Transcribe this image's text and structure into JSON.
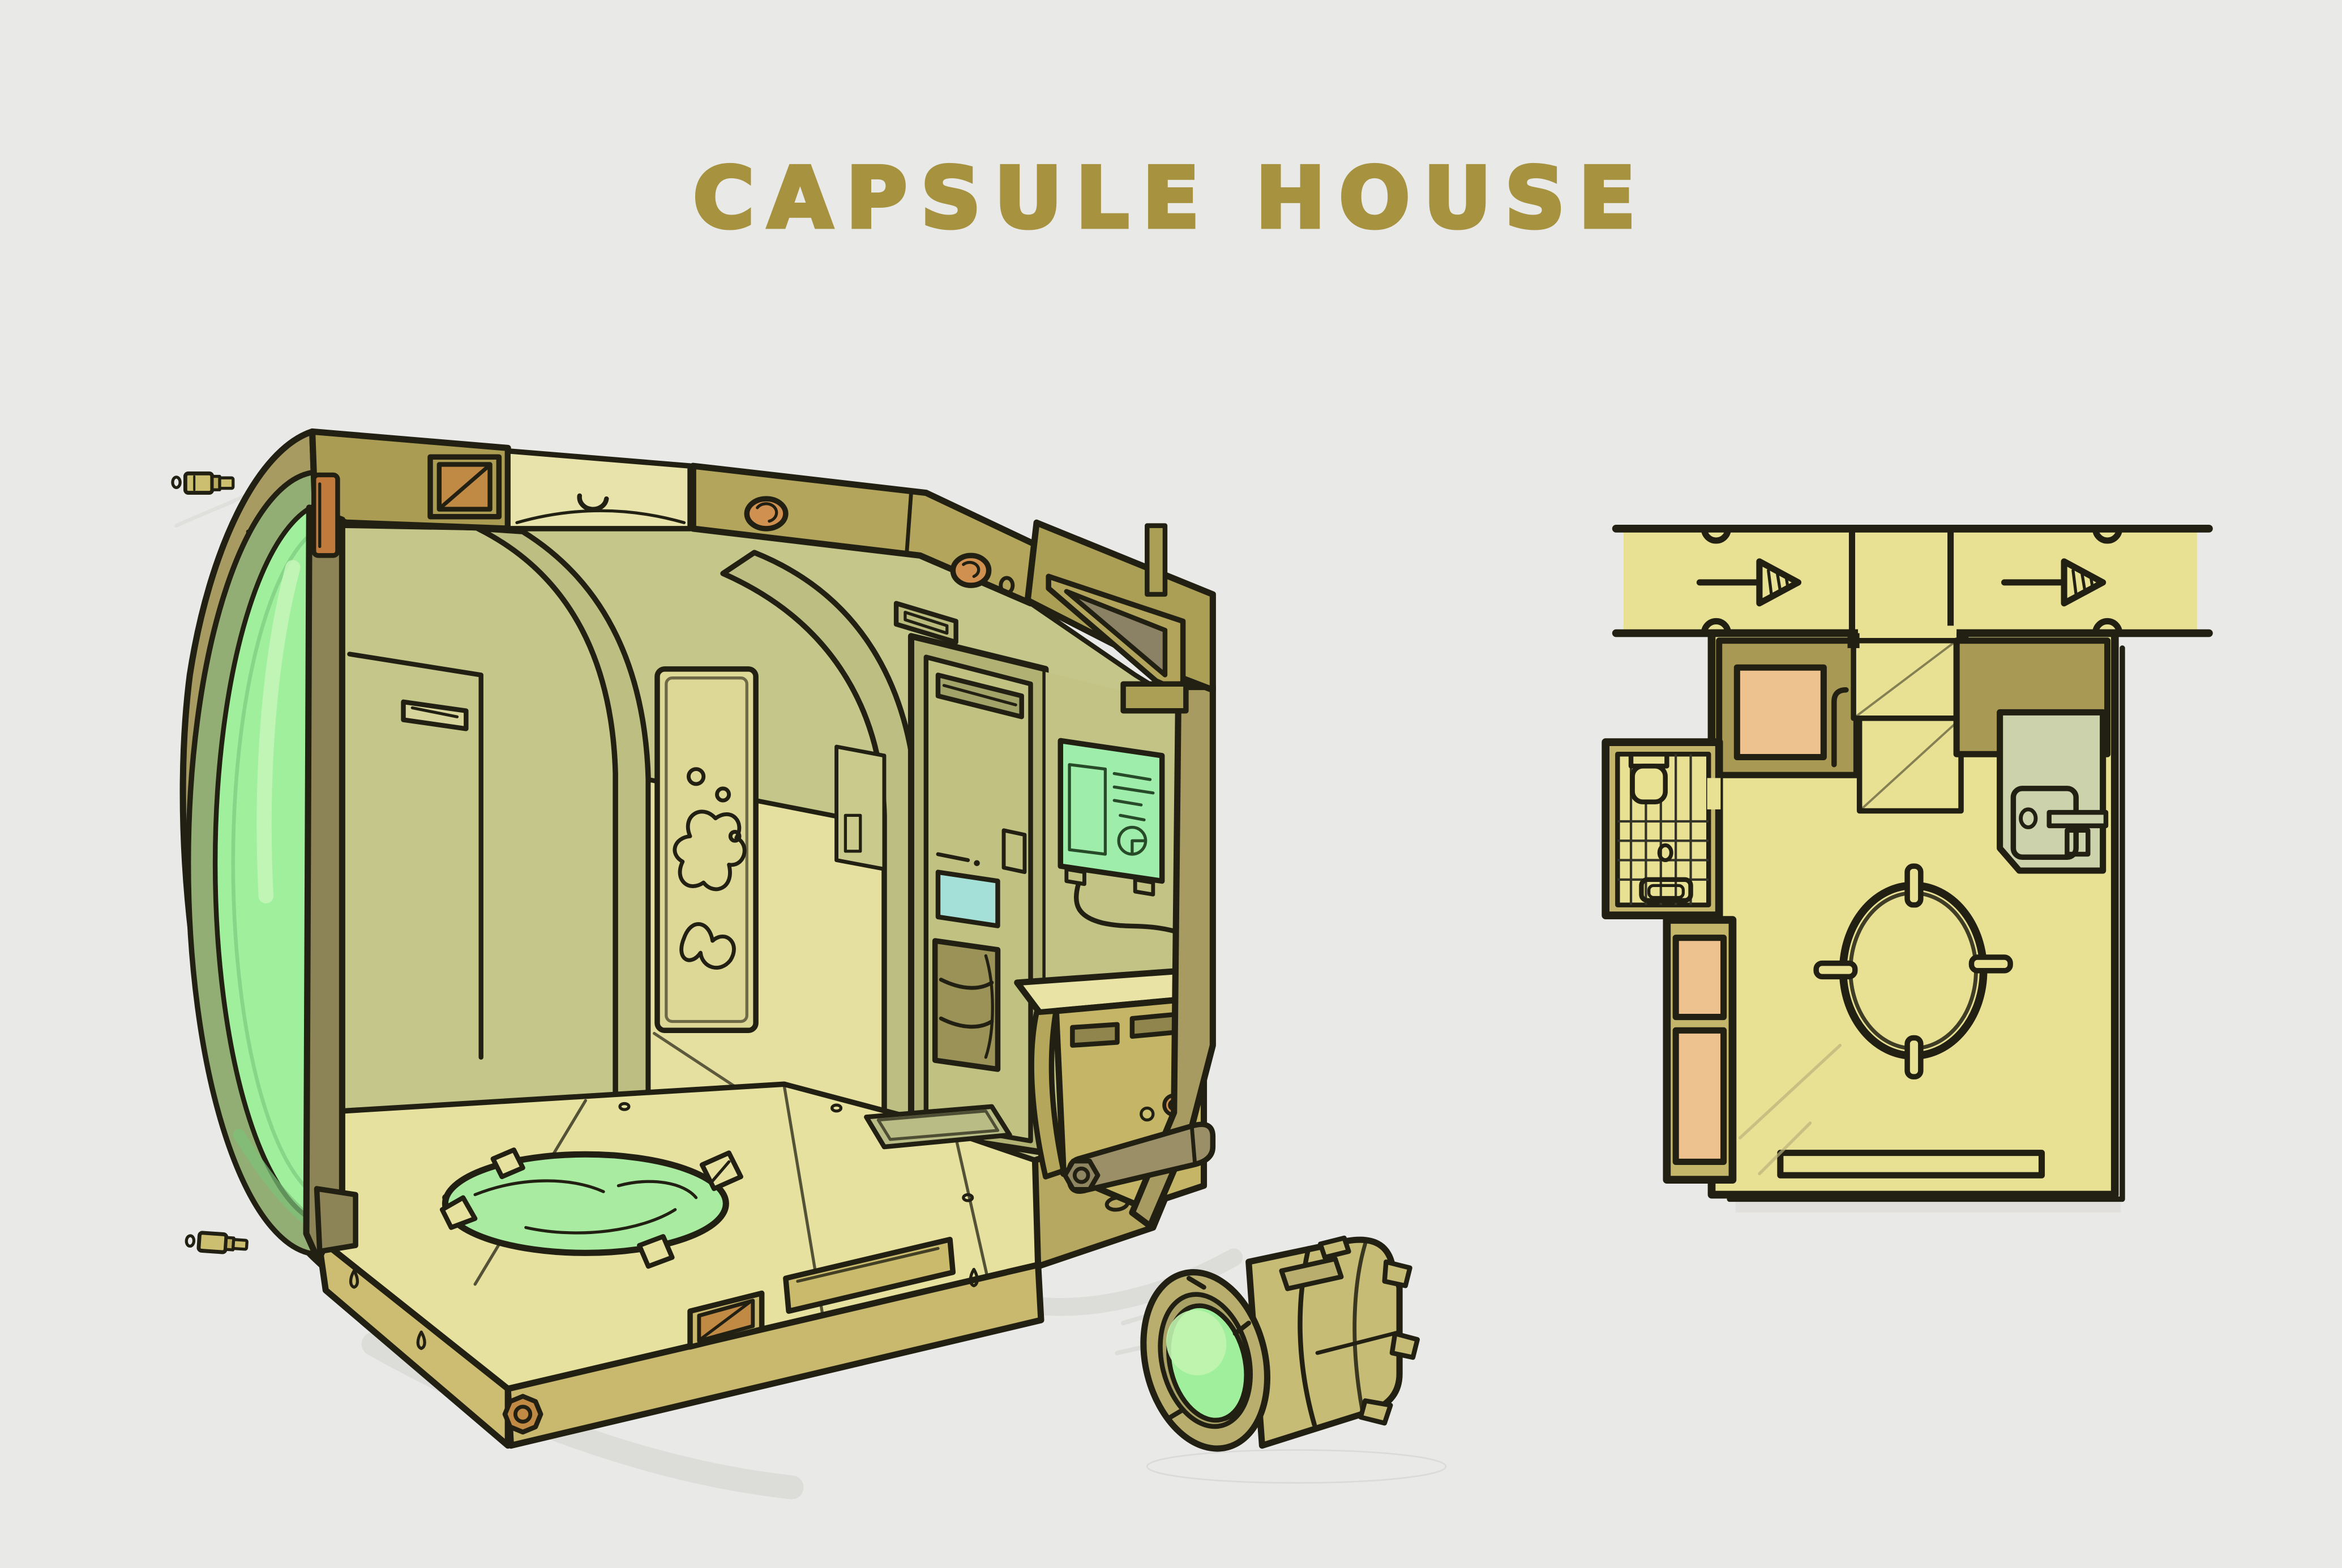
{
  "title": "CAPSULE HOUSE",
  "palette": {
    "bg": "#e9e9e7",
    "ink": "#212013",
    "title_gold": "#a6923f",
    "hull_olive": "#a89b61",
    "hull_dark": "#8c8456",
    "roof_dark": "#aa9c52",
    "roof_beam": "#b3a65c",
    "wall_olive": "#c5c68a",
    "wall_mid": "#c2c384",
    "rib_olive": "#bdbe81",
    "alcove_yellow": "#e6e0a0",
    "poster_yellow": "#ded897",
    "floor_yellow": "#e7e1a0",
    "base_light": "#cdbd72",
    "base_mid": "#c9b96e",
    "base_dark": "#b6a860",
    "glass_green": "#a0ef9d",
    "glass_ring": "#93ae74",
    "rug_green": "#a9eba1",
    "dashboard_green": "#9fedaa",
    "screen_teal": "#a4dfd8",
    "knob_orange": "#cf9050",
    "vent_orange": "#c08a45",
    "handle_orange": "#c07a3c",
    "shelf_dark": "#9b9257",
    "bracket_dark": "#8b8165",
    "pipe_gray": "#9a8f66",
    "hatch_pale": "#e8e3ab",
    "door_olive": "#c1c282",
    "frame_olive": "#b0b173",
    "plan_floor": "#e8e093",
    "plan_wall": "#a89a55",
    "plan_column": "#c3b56a",
    "plan_orange": "#eec28e",
    "plan_alcove": "#ccd2ab",
    "shadow_gray": "#d8d8d6"
  }
}
